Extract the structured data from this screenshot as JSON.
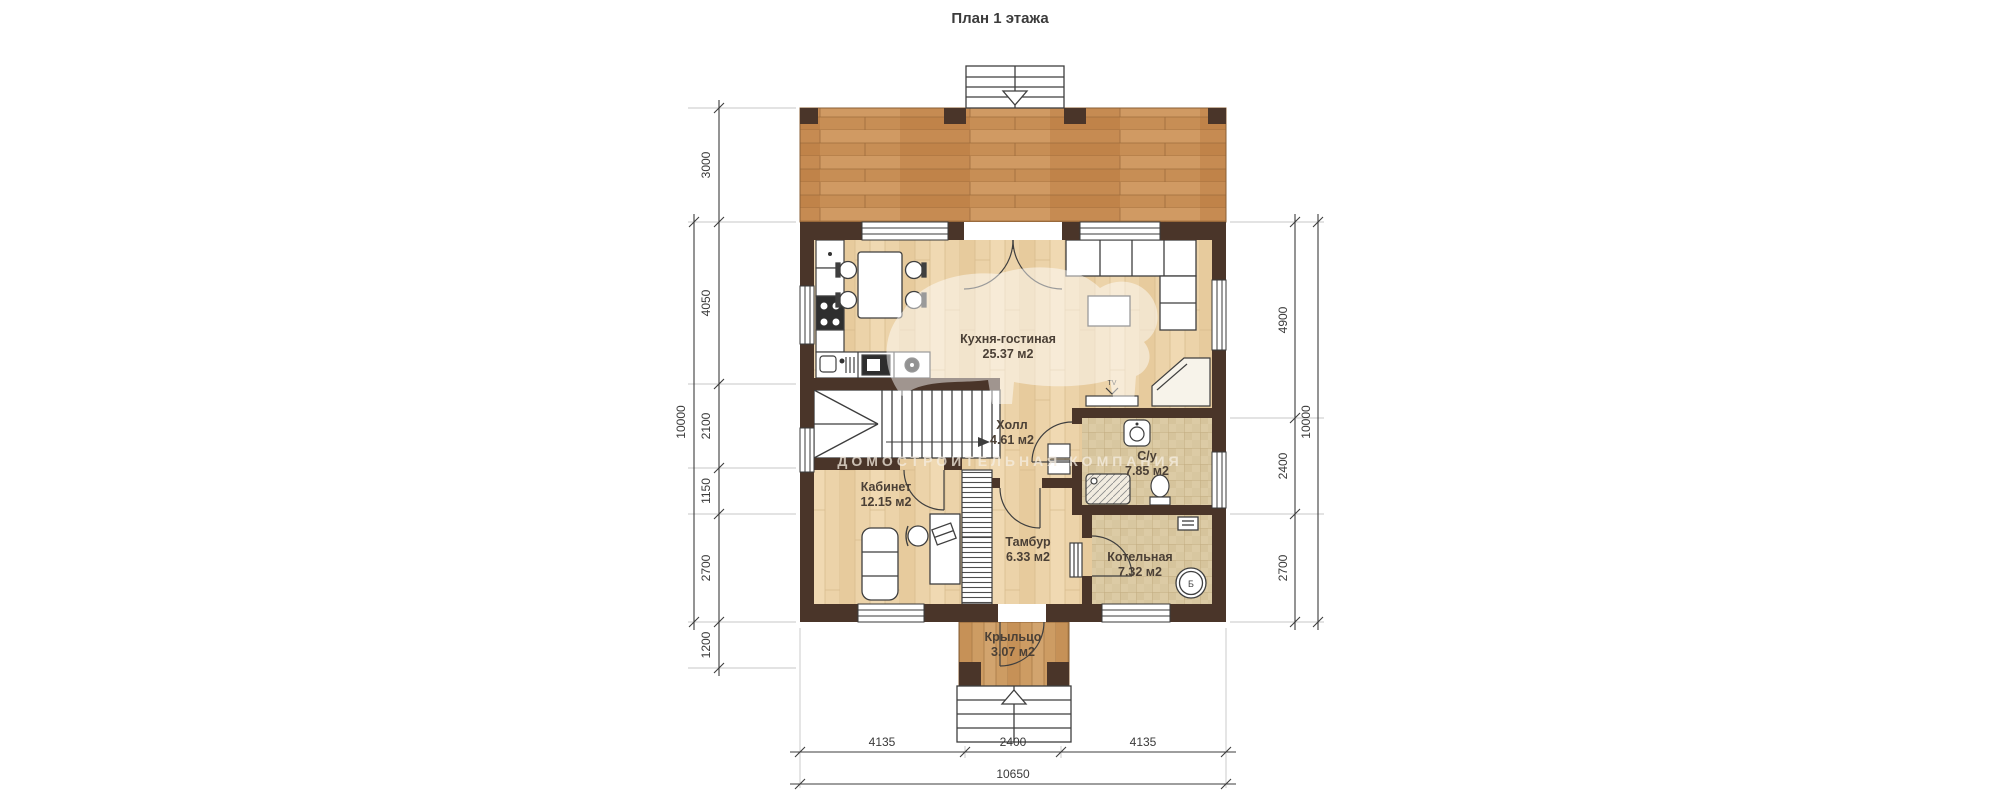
{
  "title": "План 1 этажа",
  "watermark": "ДОМОСТРОИТЕЛЬНАЯ КОМПАНИЯ",
  "rooms": {
    "kitchen_living": {
      "name": "Кухня-гостиная",
      "area": "25.37 м2"
    },
    "hall": {
      "name": "Холл",
      "area": "4.61 м2"
    },
    "office": {
      "name": "Кабинет",
      "area": "12.15 м2"
    },
    "tambour": {
      "name": "Тамбур",
      "area": "6.33 м2"
    },
    "bathroom": {
      "name": "С/у",
      "area": "7.85 м2"
    },
    "boiler_room": {
      "name": "Котельная",
      "area": "7.32 м2"
    },
    "porch": {
      "name": "Крыльцо",
      "area": "3.07 м2"
    }
  },
  "dims": {
    "left": [
      "3000",
      "4050",
      "2100",
      "1150",
      "2700",
      "1200"
    ],
    "left_total": "10000",
    "right": [
      "4900",
      "2400",
      "2700"
    ],
    "right_total": "10000",
    "bottom": [
      "4135",
      "2400",
      "4135"
    ],
    "bottom_total": "10650"
  },
  "labels": {
    "tv": "TV",
    "boiler": "Б"
  },
  "colors": {
    "wall": "#4a3529",
    "terrace_wood": "#c98f57",
    "floor_wood": "#ecd3a9",
    "porch_wood": "#cd9c63",
    "tile": "#dccba5",
    "line": "#3f3f3f"
  }
}
